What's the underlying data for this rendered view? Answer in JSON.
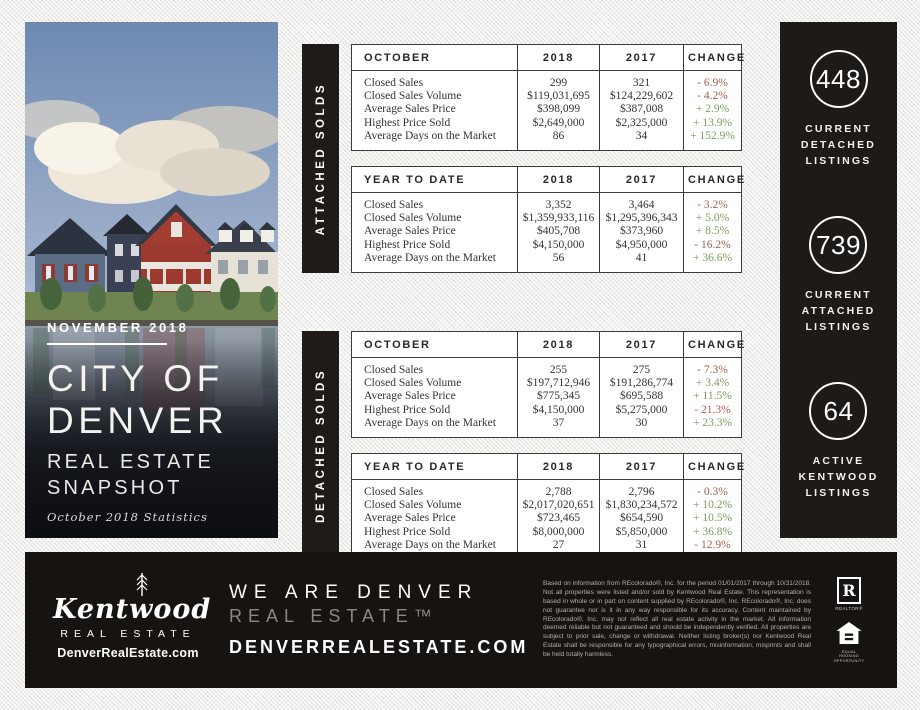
{
  "colors": {
    "panel_black": "#201b19",
    "footer_black": "#171310",
    "negative": "#a35f4f",
    "positive": "#7f9c5e"
  },
  "hero": {
    "month_label": "NOVEMBER 2018",
    "title_line1": "CITY OF",
    "title_line2": "DENVER",
    "subtitle_line1": "REAL ESTATE",
    "subtitle_line2": "SNAPSHOT",
    "note": "October 2018 Statistics"
  },
  "columns": {
    "y2018": "2018",
    "y2017": "2017",
    "change": "CHANGE"
  },
  "sections": [
    {
      "label": "ATTACHED SOLDS",
      "tables": [
        {
          "period": "OCTOBER",
          "rows": [
            {
              "metric": "Closed Sales",
              "y2018": "299",
              "y2017": "321",
              "change": "- 6.9%",
              "direction": "neg"
            },
            {
              "metric": "Closed Sales Volume",
              "y2018": "$119,031,695",
              "y2017": "$124,229,602",
              "change": "- 4.2%",
              "direction": "neg"
            },
            {
              "metric": "Average Sales Price",
              "y2018": "$398,099",
              "y2017": "$387,008",
              "change": "+ 2.9%",
              "direction": "pos"
            },
            {
              "metric": "Highest Price Sold",
              "y2018": "$2,649,000",
              "y2017": "$2,325,000",
              "change": "+ 13.9%",
              "direction": "pos"
            },
            {
              "metric": "Average Days on the Market",
              "y2018": "86",
              "y2017": "34",
              "change": "+ 152.9%",
              "direction": "pos"
            }
          ]
        },
        {
          "period": "YEAR TO DATE",
          "rows": [
            {
              "metric": "Closed Sales",
              "y2018": "3,352",
              "y2017": "3,464",
              "change": "- 3.2%",
              "direction": "neg"
            },
            {
              "metric": "Closed Sales Volume",
              "y2018": "$1,359,933,116",
              "y2017": "$1,295,396,343",
              "change": "+ 5.0%",
              "direction": "pos"
            },
            {
              "metric": "Average Sales Price",
              "y2018": "$405,708",
              "y2017": "$373,960",
              "change": "+ 8.5%",
              "direction": "pos"
            },
            {
              "metric": "Highest Price Sold",
              "y2018": "$4,150,000",
              "y2017": "$4,950,000",
              "change": "- 16.2%",
              "direction": "neg"
            },
            {
              "metric": "Average Days on the Market",
              "y2018": "56",
              "y2017": "41",
              "change": "+ 36.6%",
              "direction": "pos"
            }
          ]
        }
      ]
    },
    {
      "label": "DETACHED SOLDS",
      "tables": [
        {
          "period": "OCTOBER",
          "rows": [
            {
              "metric": "Closed Sales",
              "y2018": "255",
              "y2017": "275",
              "change": "- 7.3%",
              "direction": "neg"
            },
            {
              "metric": "Closed Sales Volume",
              "y2018": "$197,712,946",
              "y2017": "$191,286,774",
              "change": "+ 3.4%",
              "direction": "pos"
            },
            {
              "metric": "Average Sales Price",
              "y2018": "$775,345",
              "y2017": "$695,588",
              "change": "+ 11.5%",
              "direction": "pos"
            },
            {
              "metric": "Highest Price Sold",
              "y2018": "$4,150,000",
              "y2017": "$5,275,000",
              "change": "- 21.3%",
              "direction": "neg"
            },
            {
              "metric": "Average Days on the Market",
              "y2018": "37",
              "y2017": "30",
              "change": "+ 23.3%",
              "direction": "pos"
            }
          ]
        },
        {
          "period": "YEAR TO DATE",
          "rows": [
            {
              "metric": "Closed Sales",
              "y2018": "2,788",
              "y2017": "2,796",
              "change": "- 0.3%",
              "direction": "neg"
            },
            {
              "metric": "Closed Sales Volume",
              "y2018": "$2,017,020,651",
              "y2017": "$1,830,234,572",
              "change": "+ 10.2%",
              "direction": "pos"
            },
            {
              "metric": "Average Sales Price",
              "y2018": "$723,465",
              "y2017": "$654,590",
              "change": "+ 10.5%",
              "direction": "pos"
            },
            {
              "metric": "Highest Price Sold",
              "y2018": "$8,000,000",
              "y2017": "$5,850,000",
              "change": "+ 36.8%",
              "direction": "pos"
            },
            {
              "metric": "Average Days on the Market",
              "y2018": "27",
              "y2017": "31",
              "change": "- 12.9%",
              "direction": "neg"
            }
          ]
        }
      ]
    }
  ],
  "sidebar": {
    "stats": [
      {
        "value": "448",
        "lines": [
          "CURRENT",
          "DETACHED",
          "LISTINGS"
        ]
      },
      {
        "value": "739",
        "lines": [
          "CURRENT",
          "ATTACHED",
          "LISTINGS"
        ]
      },
      {
        "value": "64",
        "lines": [
          "ACTIVE",
          "KENTWOOD",
          "LISTINGS"
        ]
      }
    ]
  },
  "footer": {
    "brand": "Kentwood",
    "brand_sub": "REAL ESTATE",
    "brand_site": "DenverRealEstate.com",
    "tagline1": "WE ARE DENVER",
    "tagline2": "REAL ESTATE™",
    "website": "DENVERREALESTATE.COM",
    "disclaimer": "Based on information from REcolorado®, Inc. for the period 01/01/2017 through 10/31/2018. Not all properties were listed and/or sold by Kentwood Real Estate. This representation is based in whole or in part on content supplied by REcolorado®, Inc. REcolorado®, Inc. does not guarantee nor is it in any way responsible for its accuracy. Content maintained by REcolorado®, Inc. may not reflect all real estate activity in the market. All information deemed reliable but not guaranteed and should be independently verified. All properties are subject to prior sale, change or withdrawal. Neither listing broker(s) nor Kentwood Real Estate shall be responsible for any typographical errors, misinformation, misprints and shall be held totally harmless.",
    "realtor_letter": "R",
    "realtor_label": "REALTOR®",
    "equal_housing_label": "EQUAL HOUSING OPPORTUNITY"
  }
}
